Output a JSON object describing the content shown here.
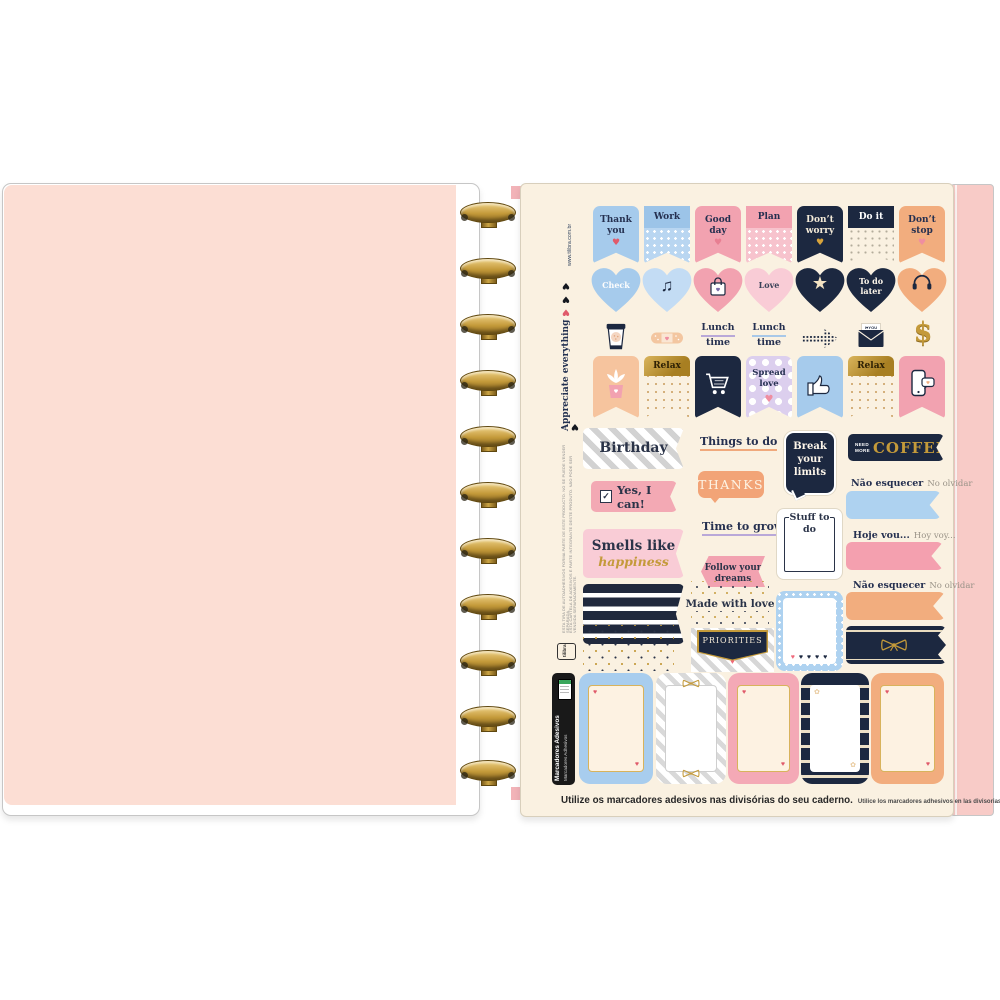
{
  "margin": {
    "url": "www.tilibra.com.br",
    "tagline": "Appreciate everything",
    "heart_pink": "♥",
    "hearts_black": "♥ ♥ ♥",
    "legal_pt": "ESTA CARTELA DE ADESIVOS É PARTE INTEGRANTE DESTE PRODUTO. NÃO PODE SER VENDIDA SEPARADAMENTE.",
    "legal_es": "ESTA TIRA DE AUTOADHESIVOS FORMA PARTE DE ESTE PRODUCTO. NO SE PUEDE VENDER SEPARADA.",
    "brand": "tilibra",
    "side_label_pt": "Marcadores Adesivos",
    "side_label_es": "Marcadores Adhesivos"
  },
  "pennants": [
    {
      "label": "Thank you",
      "heart": "♥"
    },
    {
      "label": "Work"
    },
    {
      "label": "Good day",
      "heart": "♥"
    },
    {
      "label": "Plan"
    },
    {
      "label": "Don’t worry",
      "heart": "♥"
    },
    {
      "label": "Do it"
    },
    {
      "label": "Don’t stop",
      "heart": "♥"
    }
  ],
  "hearts_row": [
    {
      "label": "Check"
    },
    {
      "glyph": "♫"
    },
    {},
    {
      "label": "Love"
    },
    {
      "glyph": "★"
    },
    {
      "label": "To do later"
    },
    {}
  ],
  "icons_row": {
    "lunch1_a": "Lunch",
    "lunch1_b": "time",
    "lunch2_a": "Lunch",
    "lunch2_b": "time",
    "envelope_note": "I♥YOU",
    "dollar": "$"
  },
  "banners": {
    "relax1": "Relax",
    "spread_love": "Spread love",
    "relax2": "Relax",
    "spread_heart": "♥"
  },
  "labels": {
    "birthday": "Birthday",
    "things_to_do": "Things to do",
    "break_limits": "Break your limits",
    "need": "NEED",
    "more": "MORE",
    "coffee": "COFFEE",
    "check_mark": "✓",
    "yes_i_can": "Yes, I can!",
    "thanks": "THANKS",
    "nao_esquecer": "Não esquecer",
    "no_olvidar": "No olvidar",
    "hoje_vou": "Hoje vou...",
    "hoy_voy": "Hoy voy...",
    "smells_1": "Smells like",
    "smells_2": "happiness",
    "time_to_grow": "Time to grow",
    "stuff_to_do": "Stuff to do",
    "follow_1": "Follow your",
    "follow_2": "dreams",
    "made_with_love": "Made with love",
    "priorities": "PRIORITIES",
    "priorities_heart": "♥",
    "frame_hearts": "♥ ♥ ♥ ♥",
    "flower": "✿",
    "corner_heart": "♥"
  },
  "caption": {
    "bold": "Utilize os marcadores adesivos nas divisórias do seu caderno.",
    "small": "Utilice los marcadores adhesivos en las divisorias de su cuaderno."
  },
  "colors": {
    "navy": "#1c2840",
    "blue": "#a6cbec",
    "blue_light": "#c3dcf4",
    "pink": "#f2a2b0",
    "pink_light": "#f9ccd6",
    "peach": "#f2ad7e",
    "gold": "#c49a3a",
    "cream_sheet": "#faf1e1",
    "lavender": "#dccfee",
    "page_pink": "#fcded4",
    "cover_pink": "#f8cbc7"
  }
}
